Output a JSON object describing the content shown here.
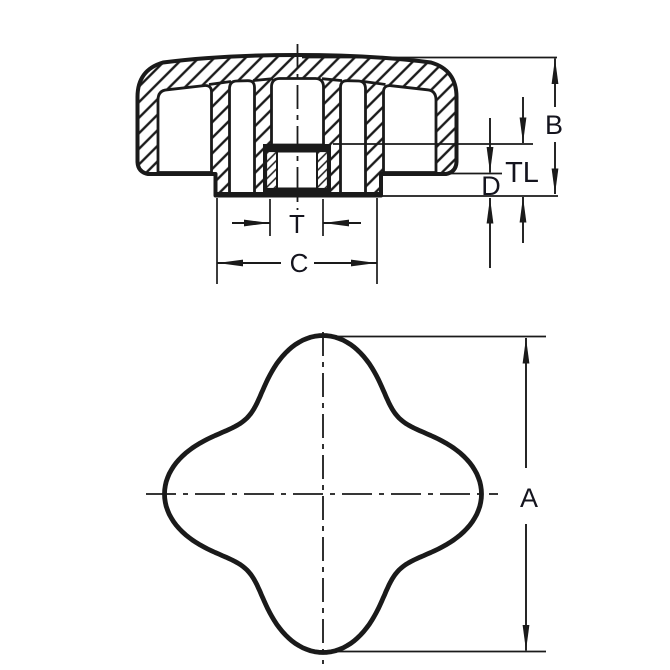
{
  "drawing": {
    "background": "#ffffff",
    "line_color": "#1a1a1a",
    "section_view": {
      "dim_b": "B",
      "dim_tl": "TL",
      "dim_d": "D",
      "dim_t": "T",
      "dim_c": "C"
    },
    "plan_view": {
      "dim_a": "A"
    }
  }
}
